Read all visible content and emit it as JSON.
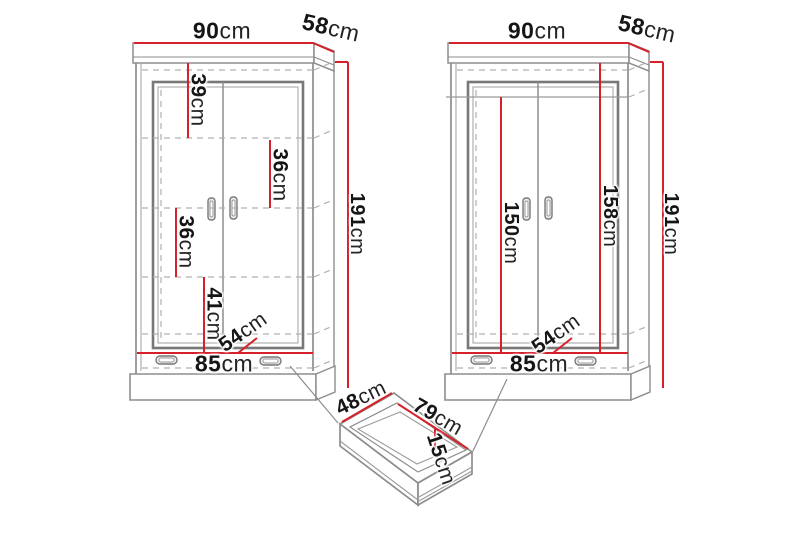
{
  "diagram": {
    "background": "#ffffff",
    "accent_red": "#d6212b",
    "line_gray": "#8d8d8d",
    "wardrobe_left": {
      "width": {
        "value": "90",
        "unit": "cm"
      },
      "depth": {
        "value": "58",
        "unit": "cm"
      },
      "height": {
        "value": "191",
        "unit": "cm"
      },
      "section_top": {
        "value": "39",
        "unit": "cm"
      },
      "section_upper": {
        "value": "36",
        "unit": "cm"
      },
      "section_lower": {
        "value": "36",
        "unit": "cm"
      },
      "section_bottom": {
        "value": "41",
        "unit": "cm"
      },
      "interior_width": {
        "value": "85",
        "unit": "cm"
      },
      "interior_depth": {
        "value": "54",
        "unit": "cm"
      }
    },
    "wardrobe_right": {
      "width": {
        "value": "90",
        "unit": "cm"
      },
      "depth": {
        "value": "58",
        "unit": "cm"
      },
      "height": {
        "value": "191",
        "unit": "cm"
      },
      "interior_height": {
        "value": "158",
        "unit": "cm"
      },
      "hanging_height": {
        "value": "150",
        "unit": "cm"
      },
      "interior_width": {
        "value": "85",
        "unit": "cm"
      },
      "interior_depth": {
        "value": "54",
        "unit": "cm"
      }
    },
    "drawer": {
      "depth": {
        "value": "48",
        "unit": "cm"
      },
      "width": {
        "value": "79",
        "unit": "cm"
      },
      "height": {
        "value": "15",
        "unit": "cm"
      }
    }
  }
}
